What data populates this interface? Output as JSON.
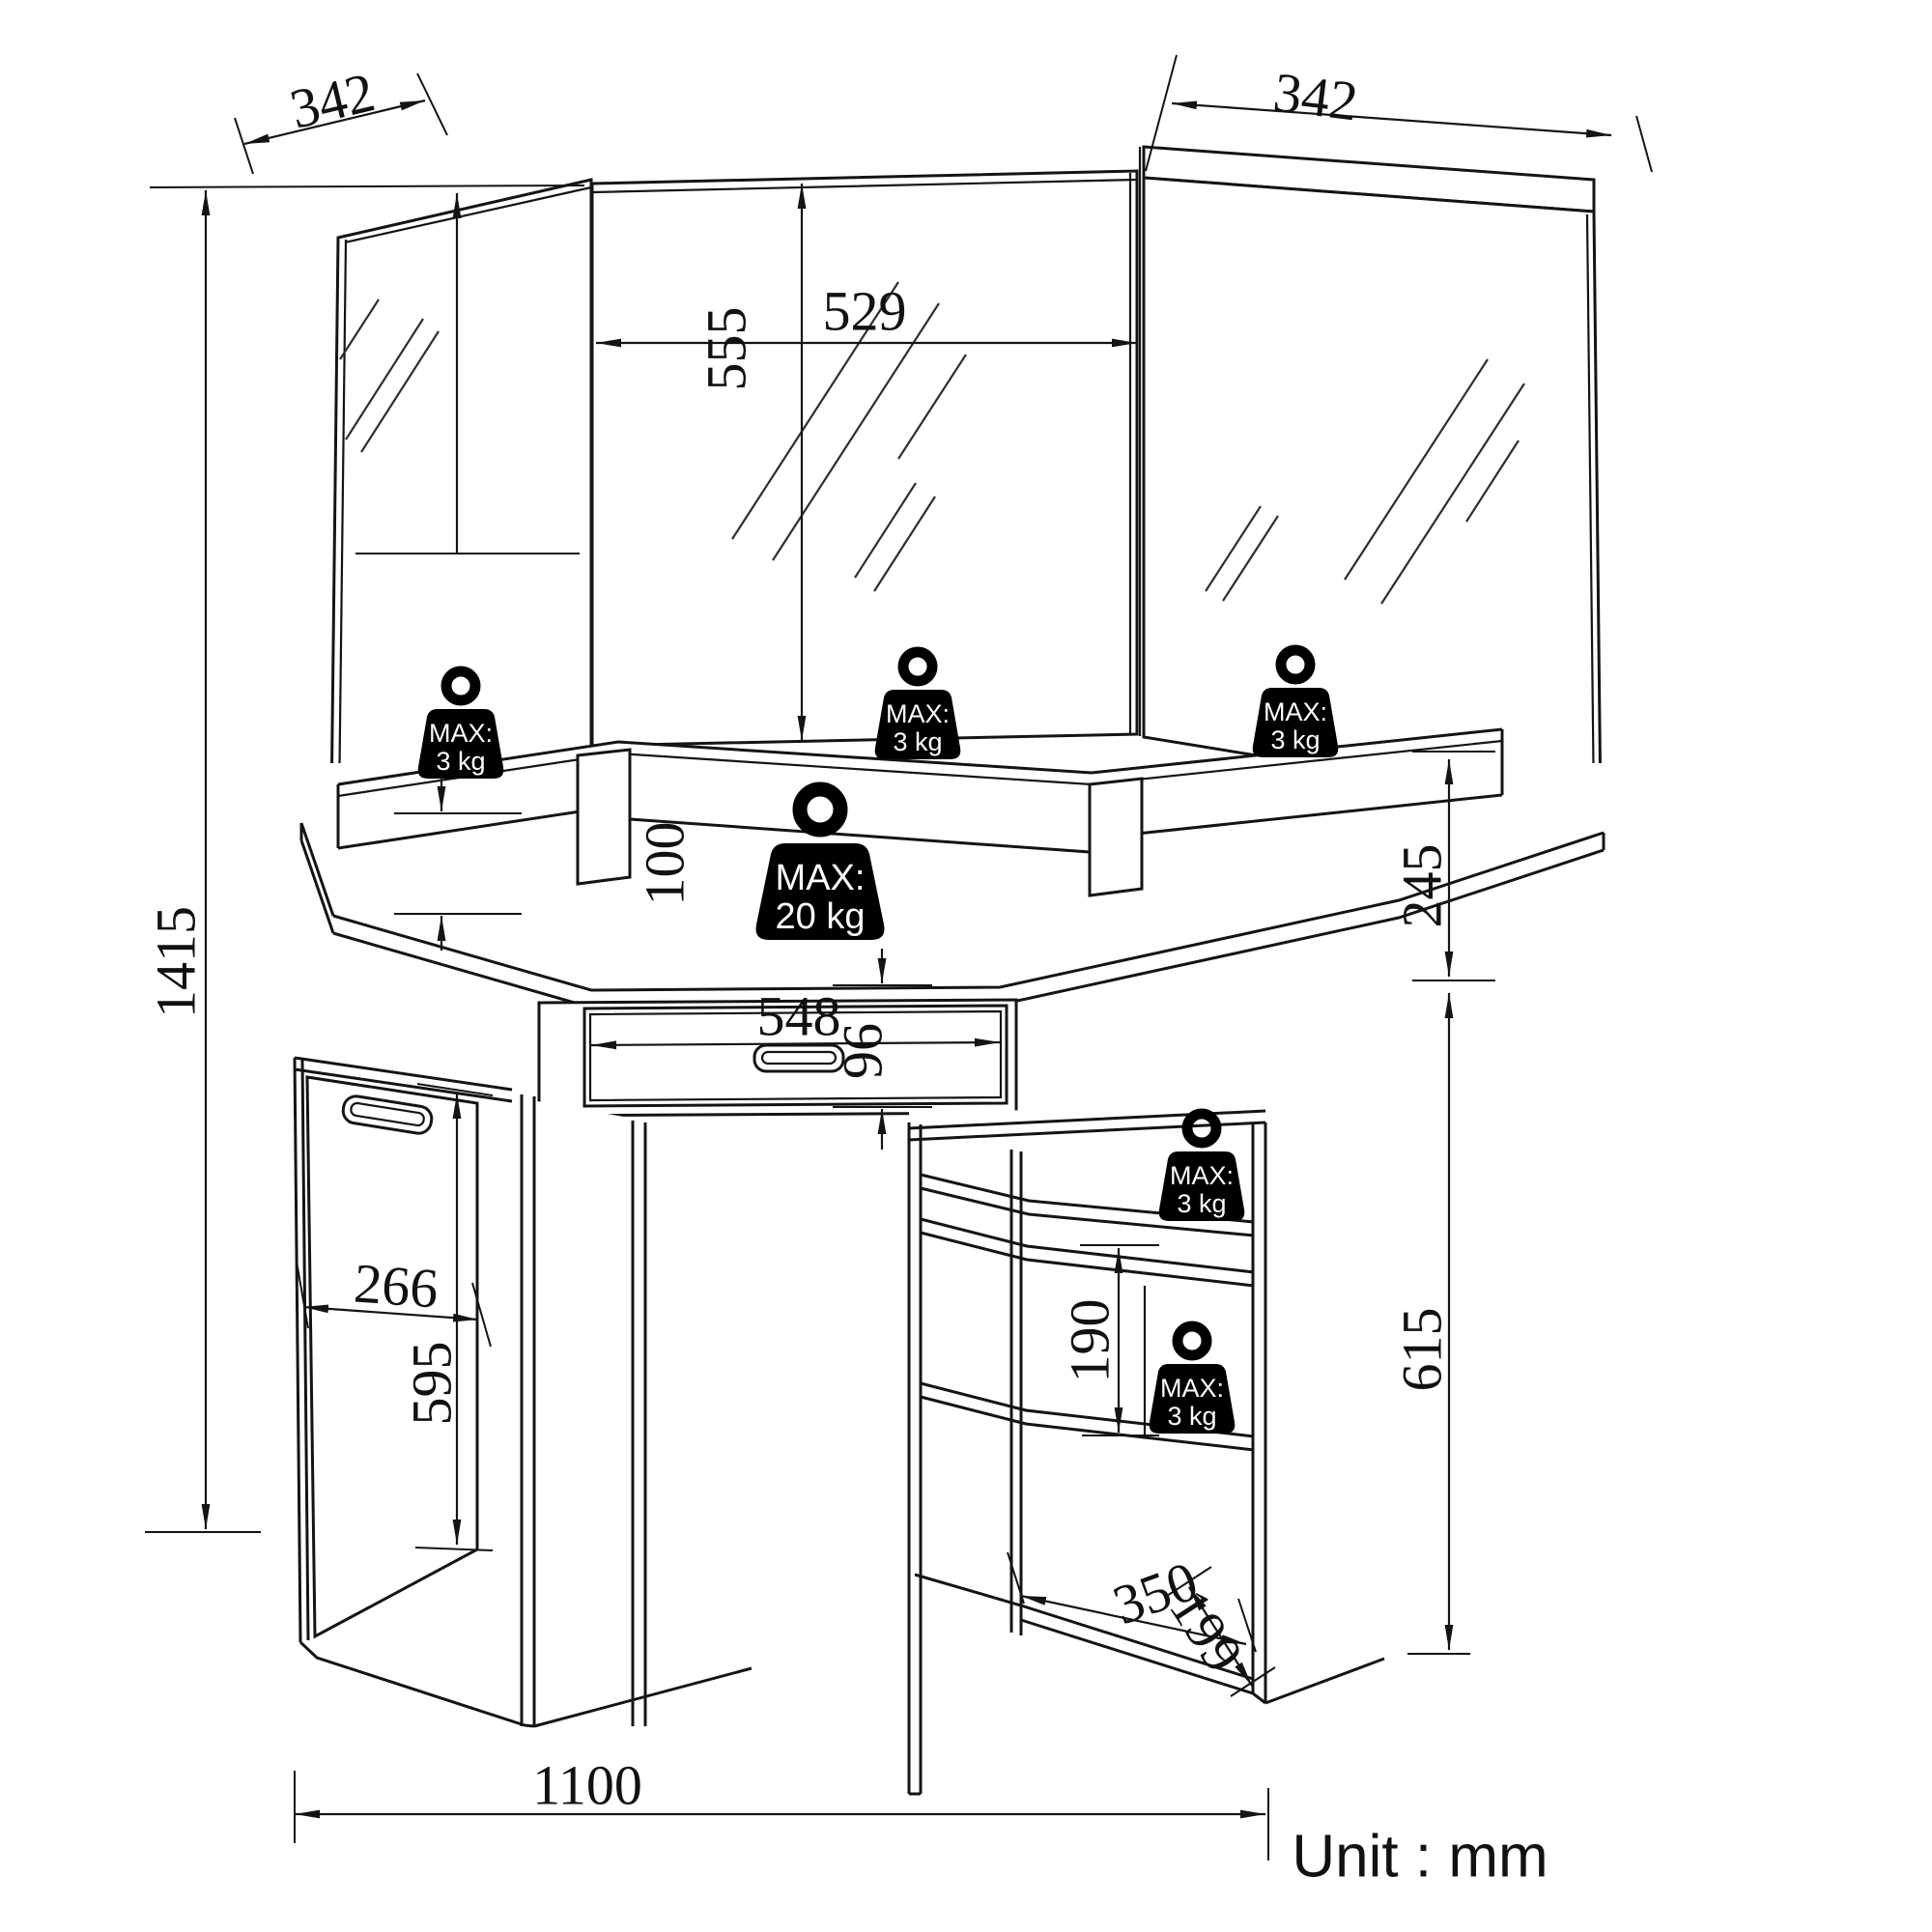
{
  "title": "Corner dressing table with tri-fold mirror — dimension drawing",
  "unit_note": "Unit : mm",
  "dims": {
    "mirror_left_width": "342",
    "mirror_right_width": "342",
    "center_mirror_width": "529",
    "center_mirror_height": "555",
    "overall_height": "1415",
    "shelf_riser_height": "100",
    "upper_section_height": "245",
    "drawer_width": "548",
    "drawer_front_height": "96",
    "door_width": "266",
    "door_height": "595",
    "shelf_spacing": "190",
    "side_unit_height": "615",
    "bottom_shelf_width": "350",
    "bottom_shelf_depth": "199",
    "overall_width": "1100"
  },
  "load_limits": {
    "shelf": {
      "line1": "MAX:",
      "line2": "3 kg"
    },
    "desktop": {
      "line1": "MAX:",
      "line2": "20 kg"
    }
  },
  "colors": {
    "line": "#141414",
    "background": "#ffffff",
    "badge": "#000000",
    "badge_text": "#ffffff"
  }
}
